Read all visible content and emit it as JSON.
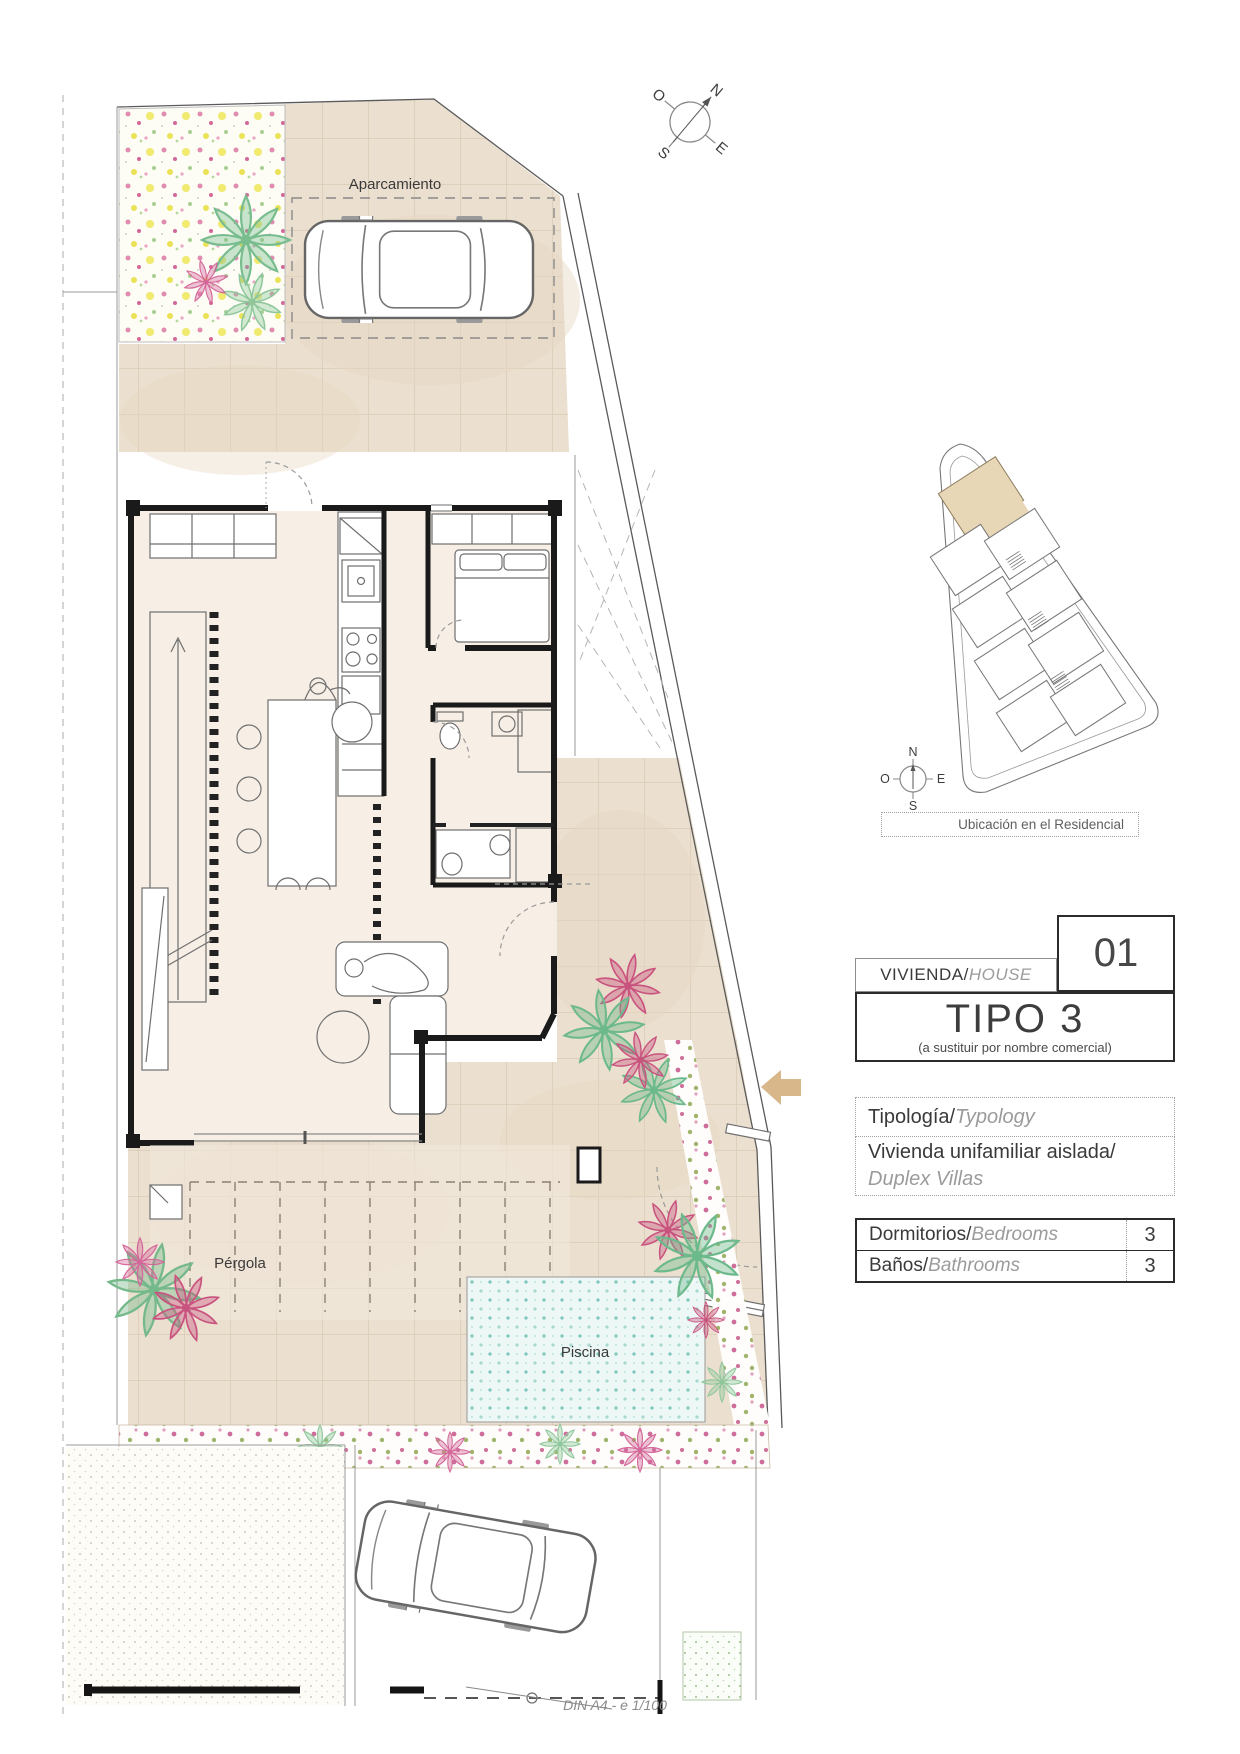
{
  "drawing": {
    "parking_label": "Aparcamiento",
    "pergola_label": "Pérgola",
    "pool_label": "Piscina",
    "scale_note": "DIN A4 - e 1/100",
    "compass": {
      "n": "N",
      "s": "S",
      "e": "E",
      "o": "O"
    }
  },
  "location_map": {
    "caption": "Ubicación en el Residencial",
    "compass": {
      "n": "N",
      "s": "S",
      "e": "E",
      "o": "O"
    }
  },
  "info": {
    "house_es": "VIVIENDA/",
    "house_en": "HOUSE",
    "unit": "01",
    "type_title": "TIPO 3",
    "type_note": "(a sustituir por nombre comercial)",
    "typology_es": "Tipología/",
    "typology_en": "Typology",
    "typology_value_es": "Vivienda unifamiliar aislada/",
    "typology_value_en": "Duplex Villas",
    "specs": [
      {
        "es": "Dormitorios/",
        "en": "Bedrooms",
        "value": "3"
      },
      {
        "es": "Baños/",
        "en": "Bathrooms",
        "value": "3"
      }
    ]
  },
  "colors": {
    "terrace": "#ebdfcf",
    "interior": "#f7efe6",
    "pool": "#edf7f5",
    "highlight_unit": "#e8d7b7",
    "wall": "#1a1a1a",
    "arrow": "#d8b78a"
  }
}
